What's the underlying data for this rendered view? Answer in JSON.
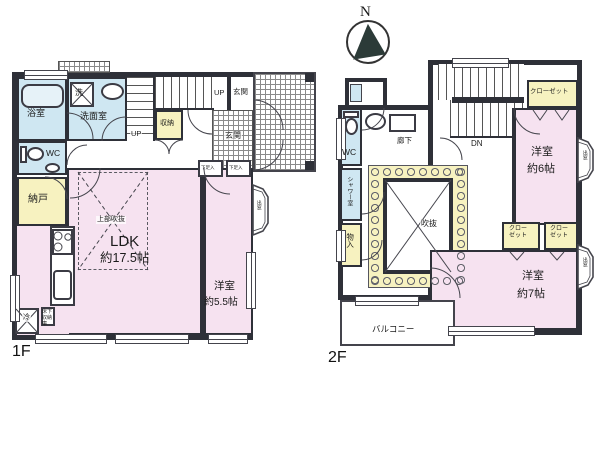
{
  "compass": {
    "north_label": "N"
  },
  "colors": {
    "wall": "#2e3038",
    "room_pink": "#f6e2f0",
    "room_blue": "#cfe7f2",
    "room_yellow": "#f7f2c0"
  },
  "floor1": {
    "floor_label": "1F",
    "bath": "浴室",
    "washer": "洗",
    "washroom": "洗面室",
    "wc": "WC",
    "storage_room": "納戸",
    "stair_closet": "収納",
    "up_label": "UP",
    "up_label2": "UP",
    "entrance_hall": "玄関",
    "entrance_tile": "玄関",
    "shoe_box1": "下足入",
    "shoe_box2": "下足入",
    "ldk_name": "LDK",
    "ldk_size": "約17.5帖",
    "open_ceiling": "上部吹抜",
    "western_name": "洋室",
    "western_size": "約5.5帖",
    "bay_window": "出窓",
    "fridge": "冷",
    "underfloor_storage": "床下収納庫"
  },
  "floor2": {
    "floor_label": "2F",
    "wc": "WC",
    "shower_room": "シャワー室",
    "storage": "物入",
    "corridor": "廊下",
    "down_label": "DN",
    "closet_main": "クローゼット",
    "closet_w7_1": "クローゼット",
    "closet_w7_2": "クローゼット",
    "western6_name": "洋室",
    "western6_size": "約6帖",
    "western7_name": "洋室",
    "western7_size": "約7帖",
    "void": "吹抜",
    "balcony": "バルコニー",
    "bay_window1": "出窓",
    "bay_window2": "出窓"
  }
}
